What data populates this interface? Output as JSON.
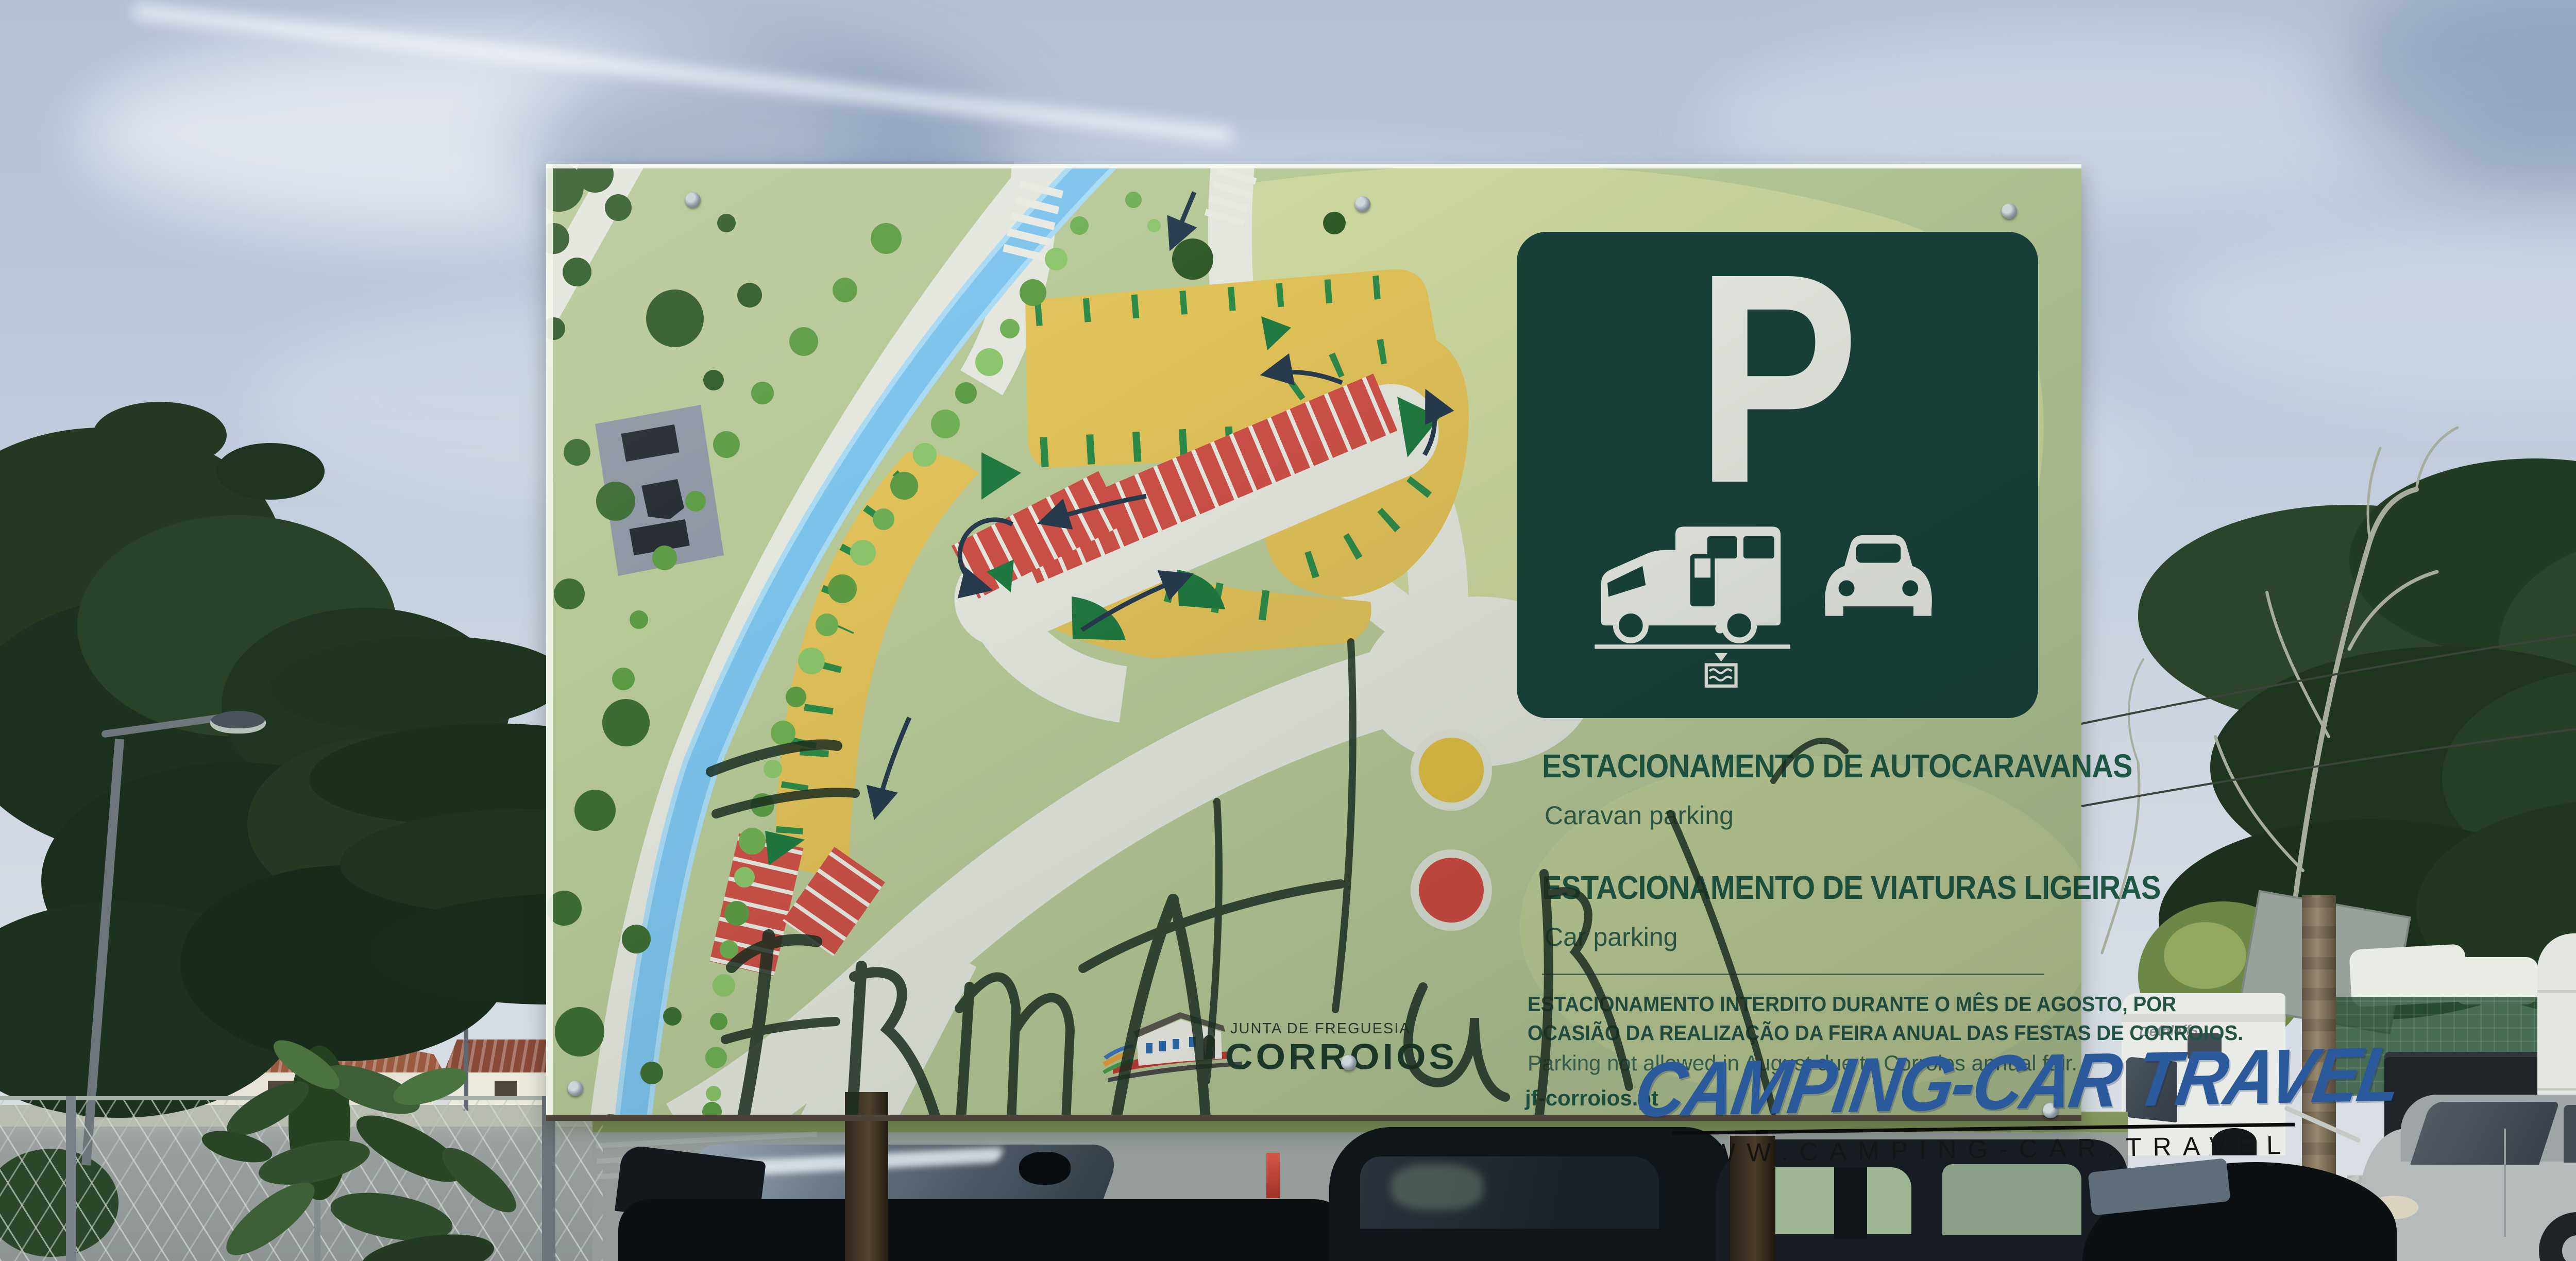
{
  "sign": {
    "p_letter": "P",
    "legend": {
      "caravan": {
        "title": "ESTACIONAMENTO DE AUTOCARAVANAS",
        "subtitle": "Caravan parking",
        "color": "#e2bf45"
      },
      "car": {
        "title": "ESTACIONAMENTO DE VIATURAS LIGEIRAS",
        "subtitle": "Car parking",
        "color": "#d14a42"
      }
    },
    "notice": {
      "pt_line1": "ESTACIONAMENTO INTERDITO DURANTE O MÊS DE AGOSTO, POR",
      "pt_line2": "OCASIÃO DA REALIZAÇÃO DA FEIRA ANUAL DAS FESTAS DE CORROIOS.",
      "en": "Parking not allowed in August due to Corroios annual fair."
    },
    "website": "jf-corroios.pt",
    "logo": {
      "authority": "JUNTA DE FREGUESIA",
      "name": "CORROIOS"
    }
  },
  "watermark": {
    "brand": "CAMPING-CAR TRAVEL",
    "url": "WWW.CAMPING-CAR.TRAVEL",
    "color": "#2a5a9c"
  },
  "background": {
    "motorhome_brand": "Dethleffs"
  },
  "colors": {
    "panel_green": "#17413a",
    "map_base": "#b7c897",
    "map_light": "#cbd69e",
    "road_white": "#e3e6dd",
    "stream_blue": "#7cc3ec",
    "caravan_yellow": "#e0c058",
    "car_red": "#cc5047",
    "tick_green": "#2c8a48",
    "text_green": "#1d5743",
    "sky": "#bcc8d8"
  }
}
